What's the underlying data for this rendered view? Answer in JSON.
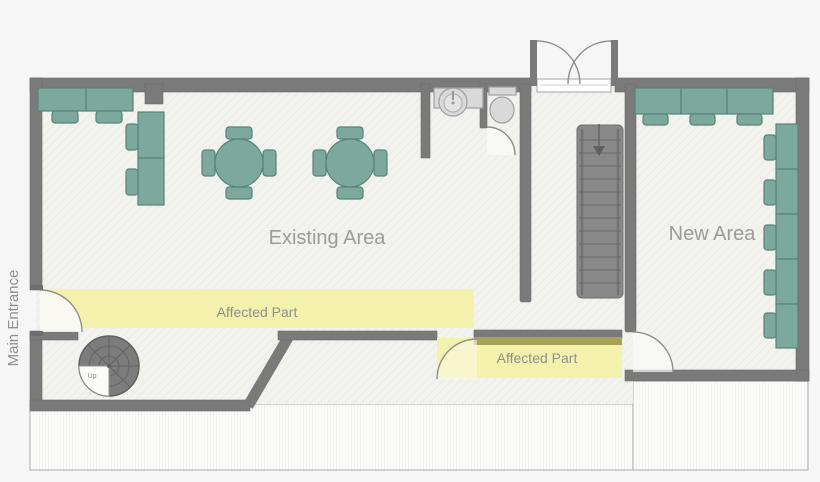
{
  "labels": {
    "existing_area": "Existing Area",
    "new_area": "New Area",
    "affected_part_left": "Affected Part",
    "affected_part_right": "Affected Part",
    "main_entrance": "Main Entrance",
    "spiral_stairs_direction": "Up"
  },
  "colors": {
    "background": "#f6f6f6",
    "floor": "#f2f2ef",
    "wall": "#7a7a7a",
    "furniture": "#7da89e",
    "furniture_border": "#578476",
    "affected_highlight": "#f4f1ad",
    "affected_wall_overlap": "#a6a358",
    "area_label_text": "#9b9b9b",
    "small_label_text": "#8f8f8f",
    "fixture": "#d9d9d9",
    "stair": "#898989"
  },
  "plan": {
    "rooms": [
      {
        "name": "Existing Area",
        "wall_desks": 4,
        "round_tables": 2,
        "chairs_per_table": 4
      },
      {
        "name": "New Area",
        "top_desks": 3,
        "side_desks": 5
      }
    ],
    "highlights": [
      {
        "name": "Affected Part",
        "position": "left-corridor"
      },
      {
        "name": "Affected Part",
        "position": "right-corridor"
      }
    ],
    "objects": [
      "main-entrance-door",
      "double-entry-door",
      "straight-staircase",
      "spiral-staircase",
      "sink",
      "toilet",
      "toilet-stall-door"
    ]
  }
}
